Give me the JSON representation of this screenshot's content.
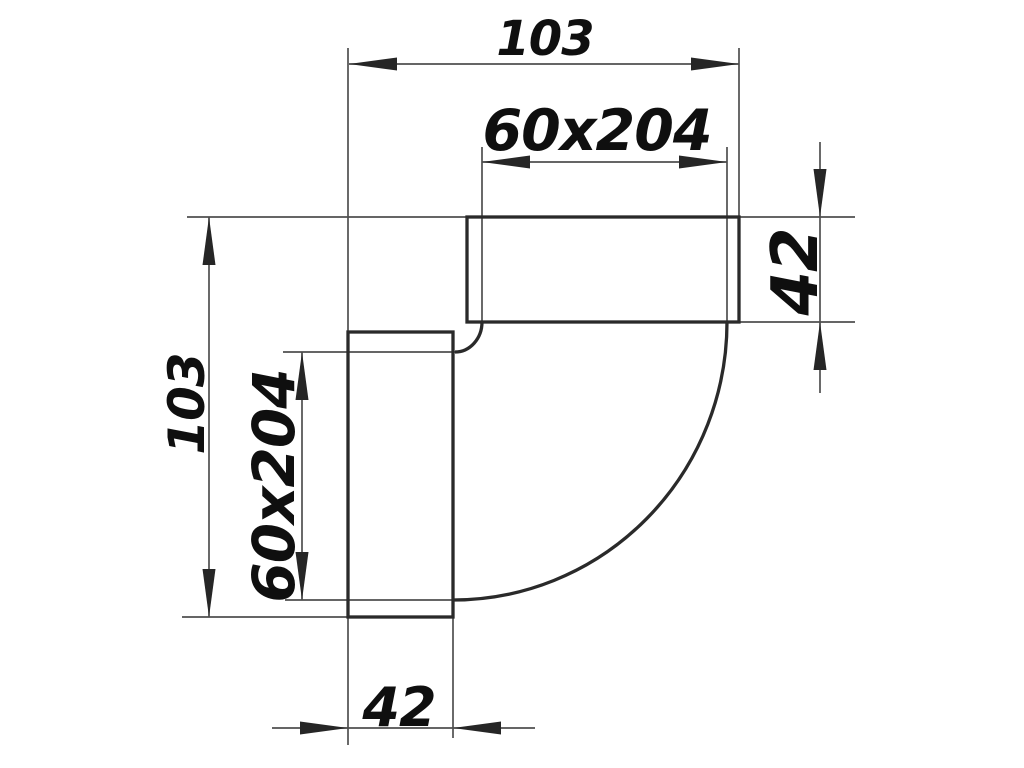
{
  "drawing": {
    "labels": {
      "top_width": "103",
      "top_connector": "60x204",
      "right_height": "42",
      "left_height": "103",
      "left_connector": "60x204",
      "bottom_width": "42"
    },
    "colors": {
      "background": "#ffffff",
      "outline": "#2a2a2a",
      "dimension": "#4f4f4f",
      "arrow": "#262626",
      "text": "#0f0f0f"
    }
  }
}
